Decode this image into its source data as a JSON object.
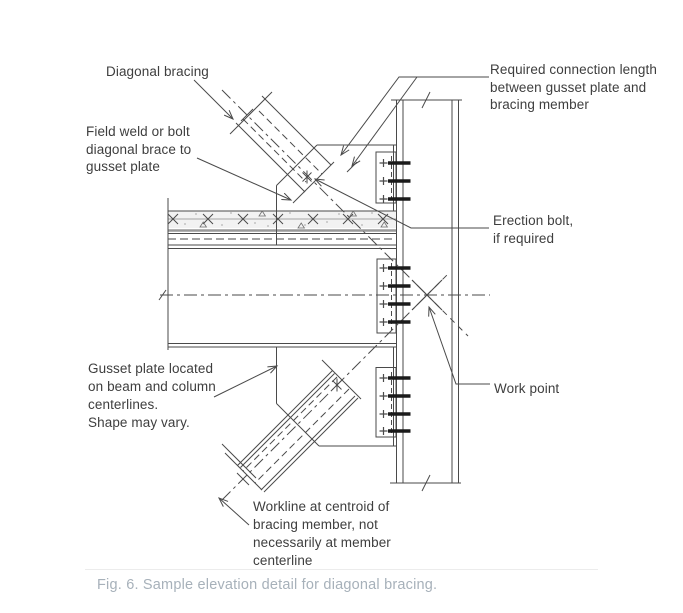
{
  "figure_caption": "Fig. 6. Sample elevation detail for diagonal bracing.",
  "labels": {
    "diagonal_bracing": {
      "lines": [
        "Diagonal bracing"
      ]
    },
    "field_weld": {
      "lines": [
        "Field weld or bolt",
        "diagonal brace to",
        "gusset plate"
      ]
    },
    "required_length": {
      "lines": [
        "Required connection length",
        "between gusset plate and",
        "bracing member"
      ]
    },
    "erection_bolt": {
      "lines": [
        "Erection bolt,",
        "if required"
      ]
    },
    "work_point": {
      "lines": [
        "Work point"
      ]
    },
    "gusset_plate": {
      "lines": [
        "Gusset plate located",
        "on beam and column",
        "centerlines.",
        "Shape may vary."
      ]
    },
    "workline": {
      "lines": [
        "Workline at centroid of",
        "bracing member, not",
        "necessarily at member",
        "centerline"
      ]
    }
  },
  "colors": {
    "line": "#4a4a4a",
    "text": "#3e3e3e",
    "caption_text": "#a7b1ba",
    "bolt": "#1a1a1a",
    "deck": "#9a9a9a",
    "slab_fill": "#f2f2f2",
    "rule": "#ececec"
  }
}
